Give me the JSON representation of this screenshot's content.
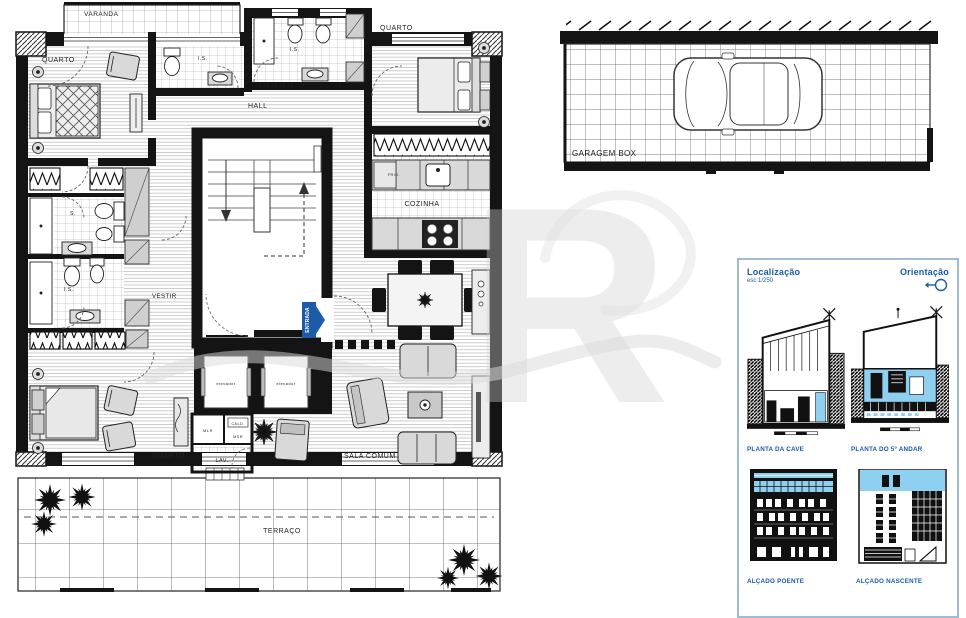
{
  "colors": {
    "accent_blue": "#1d5ba6",
    "light_blue": "#8fd0f0",
    "panel_border": "#9fbcd4",
    "wall_black": "#141414",
    "furniture_gray": "#d9d9d9",
    "watermark_gray": "#d2d2d2"
  },
  "floor_plan": {
    "varanda": "VARANDA",
    "quarto_top_left": "QUARTO",
    "is_top_left": "I.S.",
    "is_top_center": "I.S.",
    "quarto_top_right": "QUARTO",
    "hall": "HALL",
    "cozinha": "COZINHA",
    "frig": "FRIG.",
    "vestir": "VESTIR",
    "s_left": "S.",
    "is_left": "I.S.",
    "quarto_bottom": "QUARTO",
    "elevador_left": "elevador",
    "elevador_right": "elevador",
    "mlr": "MLR",
    "cald": "CALD.",
    "msr": "MSR",
    "lav": "LAV.",
    "sala_comum": "SALA COMUM",
    "entrada": "ENTRADA",
    "terraco": "TERRAÇO"
  },
  "garage": {
    "label": "GARAGEM BOX"
  },
  "panel": {
    "localizacao": "Localização",
    "escala": "esc:1/250",
    "orientacao": "Orientação",
    "planta_cave": "PLANTA DA CAVE",
    "planta_andar": "PLANTA DO 5º ANDAR",
    "alcado_poente": "ALÇADO POENTE",
    "alcado_nascente": "ALÇADO NASCENTE"
  },
  "watermark": {
    "letter": "R"
  }
}
